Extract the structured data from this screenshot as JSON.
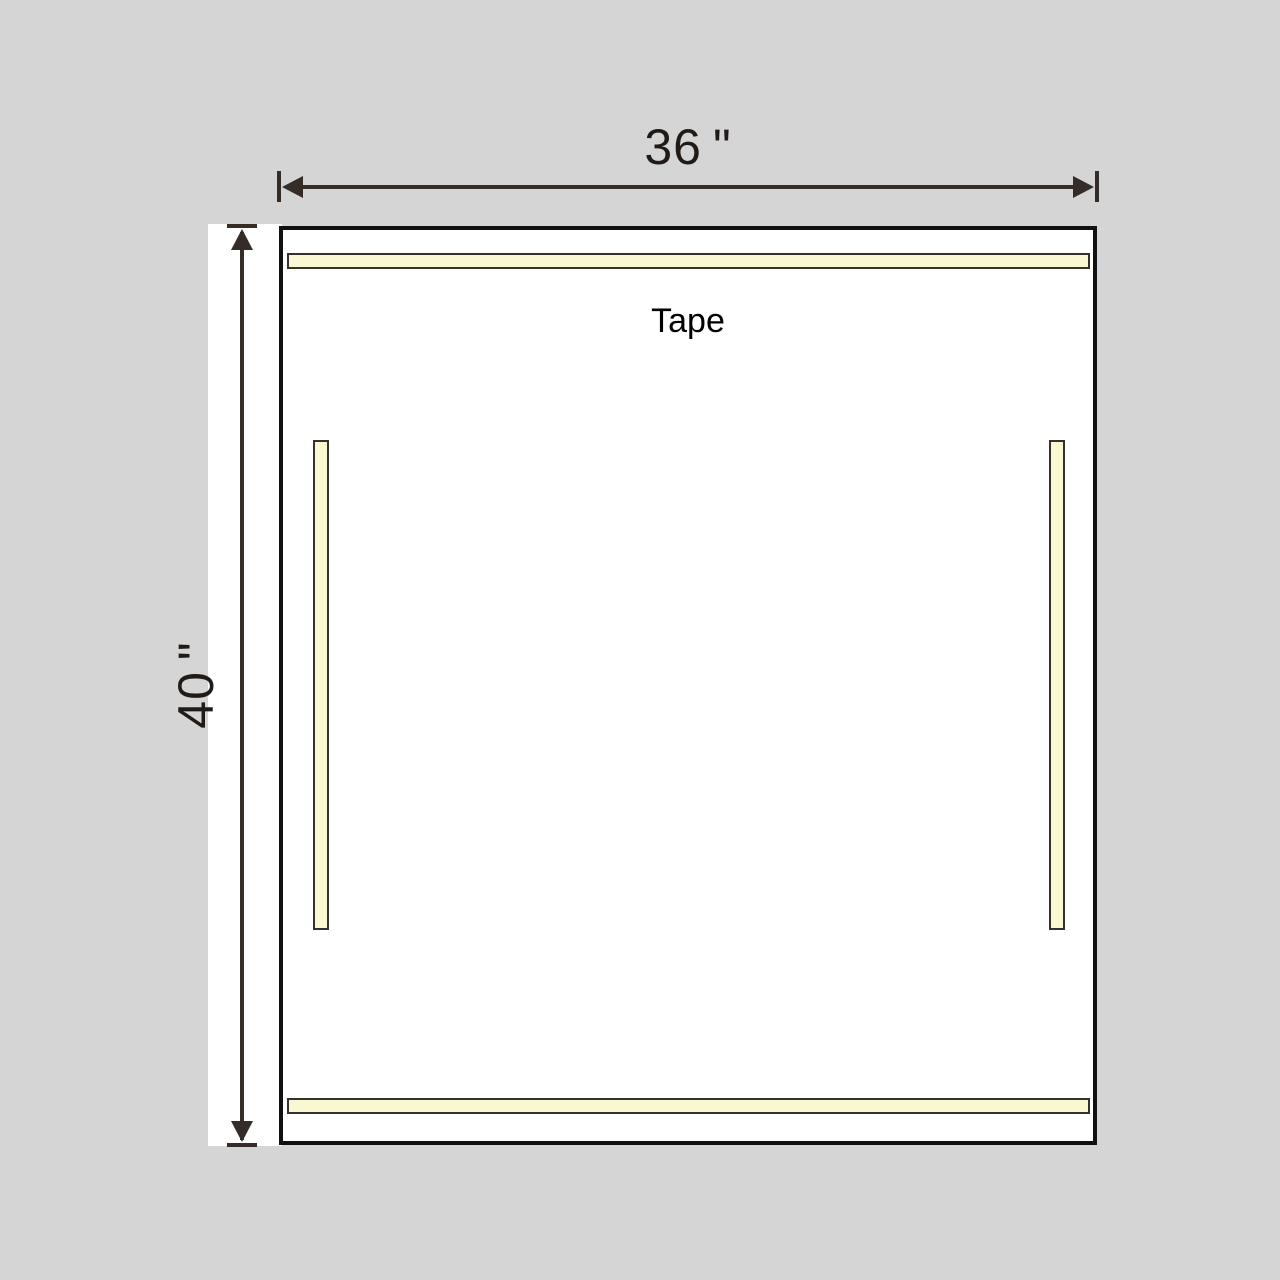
{
  "diagram": {
    "width_label": "36 \"",
    "height_label": "40 \"",
    "tape_label": "Tape"
  },
  "colors": {
    "background": "#d5d5d5",
    "panel_fill": "#ffffff",
    "panel_border": "#111111",
    "dimension": "#352b27",
    "label_text": "#211b18",
    "tape_fill": "#faf8d2",
    "tape_border": "#38302b"
  }
}
